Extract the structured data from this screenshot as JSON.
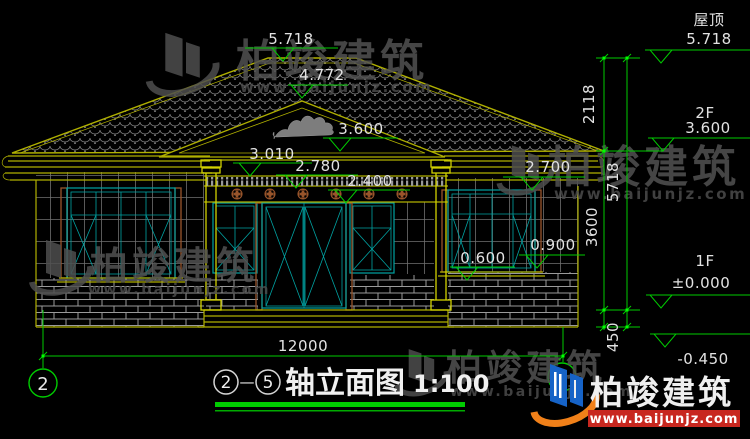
{
  "drawing": {
    "background": "#000000",
    "annotations": {
      "roof_peak_elev": "5.718",
      "pediment_apex_elev": "4.772",
      "pediment_base_elev": "3.600",
      "porch_beam_elev": "3.010",
      "frieze_elev": "2.780",
      "door_top_elev": "2.400",
      "right_eave_elev": "2.700",
      "left_window_sill_elev": "0.600",
      "right_window_sill_elev": "0.900",
      "overall_width_mm": "12000"
    },
    "right_column": {
      "roof_label": "屋顶",
      "roof_elev": "5.718",
      "dim_roof_to_2f": "2118",
      "floor2_label": "2F",
      "floor2_elev": "3.600",
      "dim_total_height": "5718",
      "dim_2f_to_1f": "3600",
      "floor1_label": "1F",
      "floor1_elev": "±0.000",
      "dim_plinth": "450",
      "ground_elev": "-0.450"
    },
    "axes": {
      "left_bubble": "2"
    }
  },
  "title_block": {
    "axis_start": "2",
    "dash": "—",
    "axis_end": "5",
    "name": "轴立面图",
    "scale": "1:100"
  },
  "watermark": {
    "brand": "柏竣建筑",
    "url": "www.baijunjz.com"
  },
  "colors": {
    "linework_olive": "#b0b000",
    "detail_teal": "#00a3a3",
    "accent_brown": "#99552b",
    "dimension_green": "#00cc00",
    "text_white": "#e2e2e2",
    "watermark_gray": "#525252",
    "logo_blue": "#1663c7",
    "logo_orange": "#f08019",
    "logo_red": "#c8271f"
  }
}
